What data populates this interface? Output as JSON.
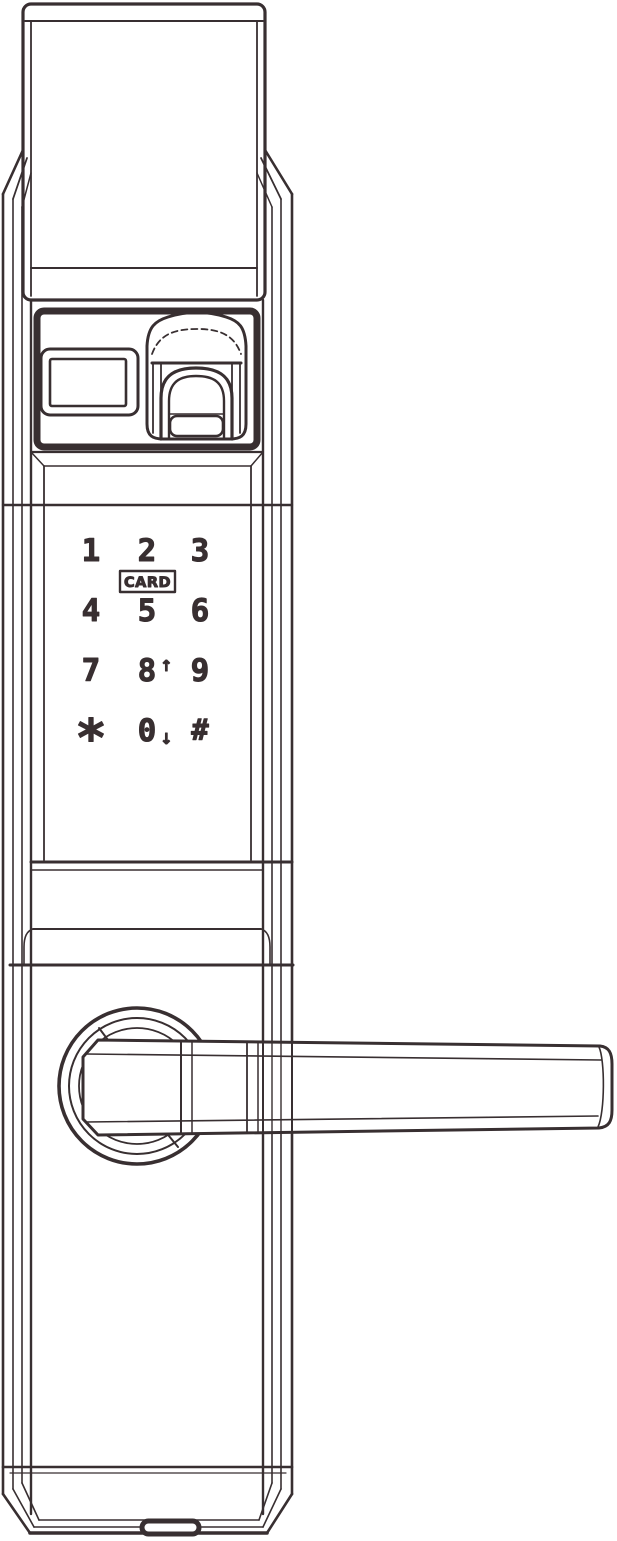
{
  "colors": {
    "line": "#382f31",
    "background": "#ffffff"
  },
  "keypad": {
    "keys": [
      {
        "id": "1",
        "label": "1"
      },
      {
        "id": "2",
        "label": "2"
      },
      {
        "id": "3",
        "label": "3"
      },
      {
        "id": "4",
        "label": "4"
      },
      {
        "id": "5",
        "label": "5"
      },
      {
        "id": "6",
        "label": "6"
      },
      {
        "id": "7",
        "label": "7"
      },
      {
        "id": "8",
        "label": "8",
        "arrow": "↑"
      },
      {
        "id": "9",
        "label": "9"
      },
      {
        "id": "star",
        "label": "*"
      },
      {
        "id": "0",
        "label": "0",
        "arrow": "↓"
      },
      {
        "id": "hash",
        "label": "#"
      }
    ],
    "card_label": "CARD"
  }
}
